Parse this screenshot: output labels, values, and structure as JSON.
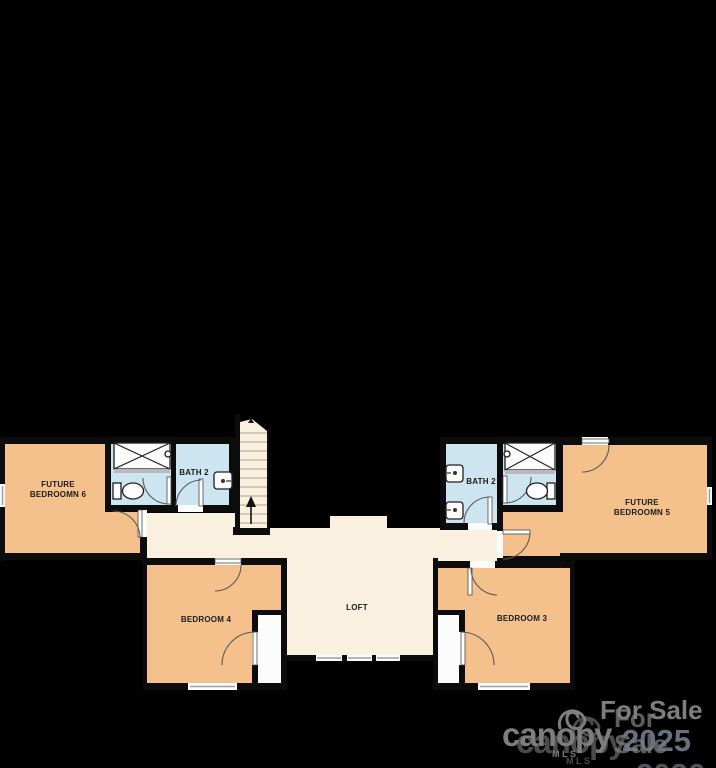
{
  "rooms": {
    "future_bedroom_6": {
      "line1": "FUTURE",
      "line2": "BEDROOMN 6"
    },
    "bath_2_left": {
      "label": "BATH 2"
    },
    "bedroom_4": {
      "label": "BEDROOM 4"
    },
    "loft": {
      "label": "LOFT"
    },
    "bedroom_3": {
      "label": "BEDROOM 3"
    },
    "bath_2_right": {
      "label": "BATH 2"
    },
    "future_bedroom_5": {
      "line1": "FUTURE",
      "line2": "BEDROOMN 5"
    }
  },
  "watermarks": {
    "brand": {
      "name": "canopy",
      "sub": "MLS"
    },
    "sale": {
      "label": "For Sale",
      "year_top": "2025",
      "year_bottom": "2026"
    }
  },
  "colors": {
    "background": "#000000",
    "wall": "#0C0C0C",
    "bedroom_fill": "#F4C08C",
    "common_fill": "#FAF0E0",
    "bath_fill": "#CDE4F1",
    "watermark_gray": "#7d7d7d",
    "watermark_year": "#66707e"
  }
}
